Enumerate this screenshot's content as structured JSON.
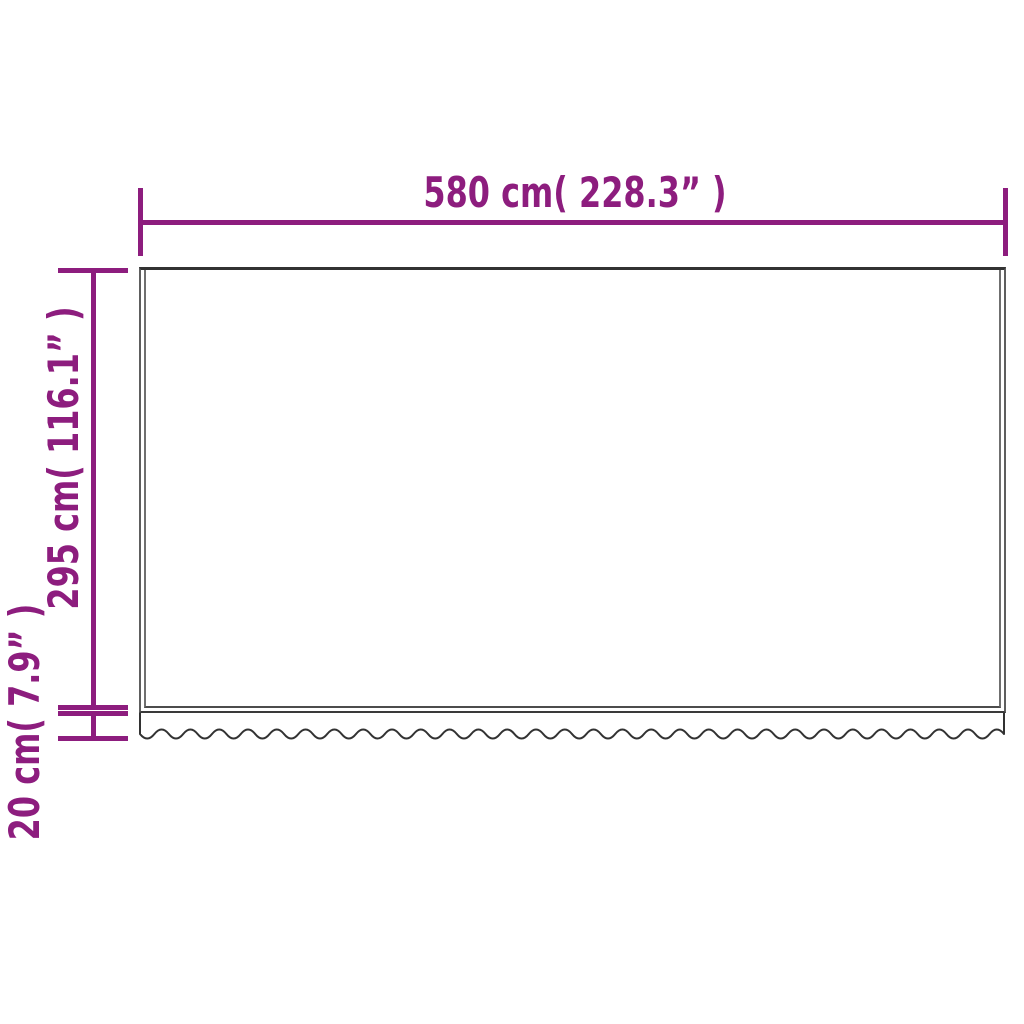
{
  "diagram": {
    "type": "product-dimension-diagram",
    "subject": "awning replacement fabric with wavy valance",
    "width_dimension": {
      "label": "580 cm( 228.3” )",
      "cm": 580,
      "inches": 228.3
    },
    "height_dimension": {
      "label": "295 cm( 116.1” )",
      "cm": 295,
      "inches": 116.1
    },
    "valance_dimension": {
      "label": "20 cm( 7.9” )",
      "cm": 20,
      "inches": 7.9
    }
  },
  "colors": {
    "accent": "#8d1d7e",
    "line": "#323232",
    "seam": "#6f6f6f",
    "background": "#ffffff"
  }
}
